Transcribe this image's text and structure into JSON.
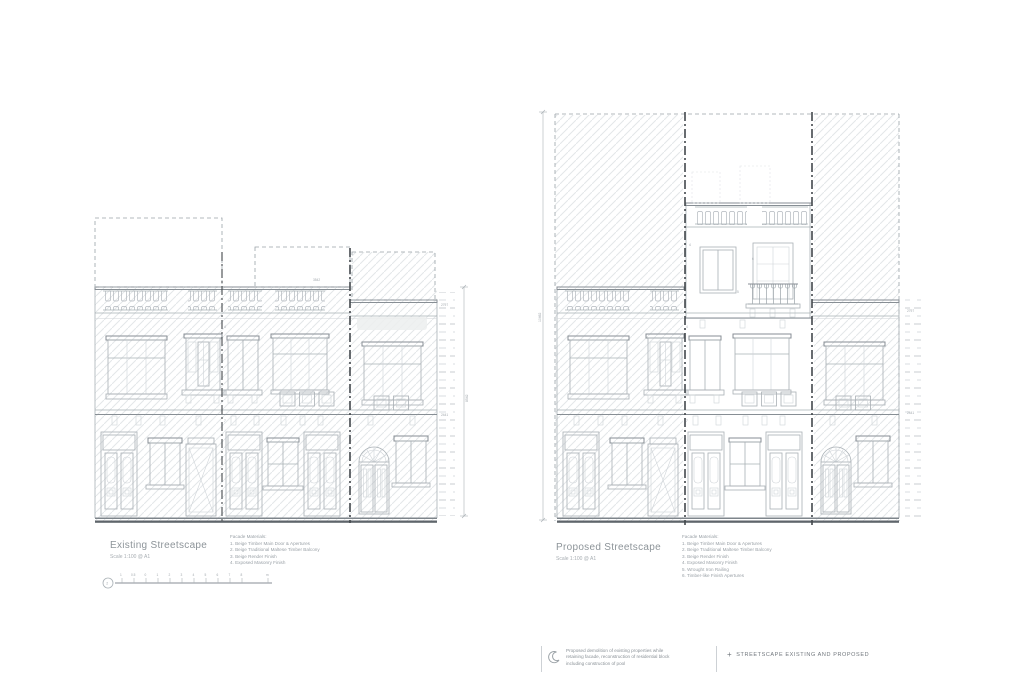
{
  "existing": {
    "title": "Existing Streetscape",
    "scale_label": "Scale 1:100 @ A1",
    "materials_title": "Facade Materials:",
    "materials": [
      "1. Beige Timber Main Door & Apertures",
      "2. Beige Traditional Maltese Timber Balcony",
      "3. Beige Render Finish",
      "4. Exposed Masonry Finish"
    ],
    "dims": {
      "width": "3542",
      "height": "8542",
      "ladder_upper": "2797",
      "ladder_lower": "2441"
    }
  },
  "proposed": {
    "title": "Proposed Streetscape",
    "scale_label": "Scale 1:100 @ A1",
    "materials_title": "Facade Materials:",
    "materials": [
      "1. Beige Timber Main Door & Apertures",
      "2. Beige Traditional Maltese Timber Balcony",
      "3. Beige Render Finish",
      "4. Exposed Masonry Finish",
      "5. Wrought Iron Railing",
      "6. Timber-like Finish Apertures"
    ],
    "dims": {
      "height": "10462",
      "ladder_upper": "2797",
      "ladder_lower": "2441"
    },
    "callouts": {
      "c4": "4",
      "c6": "6",
      "c5": "5"
    }
  },
  "street_callouts": {
    "upper": "4",
    "lower": "7"
  },
  "scalebar": {
    "ref": "2",
    "tick_labels": [
      "1",
      "0.5",
      "0",
      "1",
      "2",
      "3",
      "4",
      "5",
      "6",
      "7",
      "8"
    ],
    "unit": "m"
  },
  "notes": {
    "revision_lines": [
      "Proposed demolition of existing properties while",
      "retaining facade, reconstruction of residential block",
      "including construction of pool"
    ],
    "caption_prefix": "+",
    "caption": "STREETSCAPE EXISTING AND PROPOSED"
  },
  "colors": {
    "line": "#a9b0b5",
    "line_dark": "#878e94",
    "line_faint": "#cfd4d8",
    "boundary": "#43484c",
    "ground": "#5f656b",
    "text": "#8d9499",
    "text_light": "#a0a7ac"
  }
}
